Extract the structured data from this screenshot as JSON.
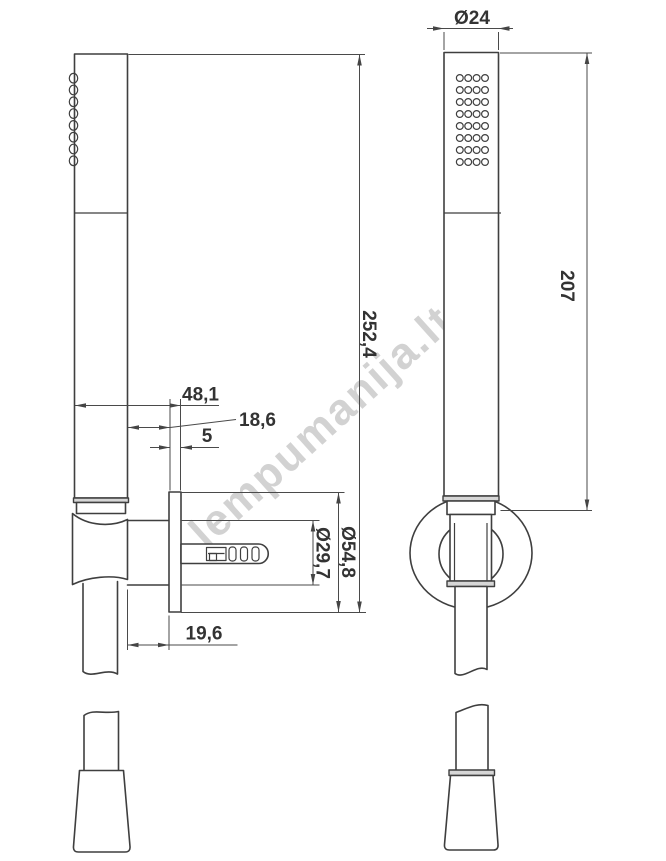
{
  "watermark": {
    "text": "lempumanija.lt",
    "color": "#a6a6a6"
  },
  "drawing": {
    "type": "technical-drawing",
    "subject": "hand shower set with wall holder, side and front views",
    "line_color": "#3f3f3f",
    "views": [
      {
        "id": "side-view",
        "description": "side view of hand shower, wall holder, plug and hose"
      },
      {
        "id": "front-view",
        "description": "front view of hand shower with spray face and holder ring"
      }
    ],
    "spray_grid": {
      "cols": 4,
      "rows": 8
    },
    "side_holes": 8,
    "dimensions": {
      "head_diameter": "Ø24",
      "handle_length": "207",
      "overall_height": "252,4",
      "offset_from_wall": "48,1",
      "holder_offset": "18,6",
      "plate_thickness": "5",
      "plate_outer_diameter": "Ø54,8",
      "plate_inner_diameter": "Ø29,7",
      "holder_depth": "19,6"
    }
  }
}
